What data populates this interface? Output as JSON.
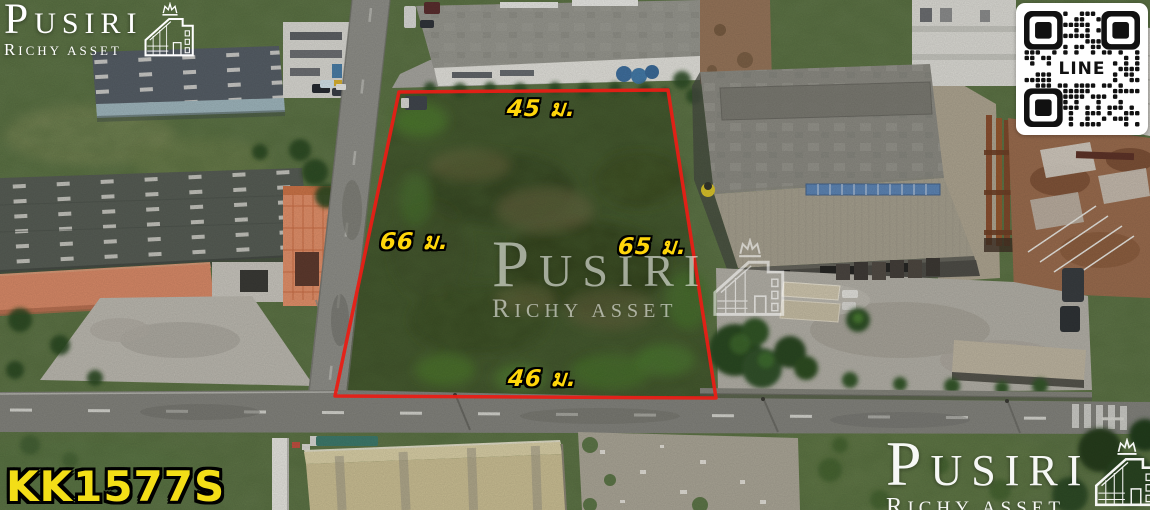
{
  "branding": {
    "line1": "PUSIRI",
    "line2": "RICHY ASSET"
  },
  "qr": {
    "label": "LINE"
  },
  "dimensions": {
    "top": "45 ม.",
    "left": "66 ม.",
    "right": "65 ม.",
    "bottom": "46 ม."
  },
  "listing_code": "KK1577S",
  "colors": {
    "plot-outline": "#e81d15",
    "dimension-label": "#ffd60a",
    "listing-code": "#f3de17",
    "qr-bg": "#ffffff",
    "qr-fg": "#111111"
  }
}
